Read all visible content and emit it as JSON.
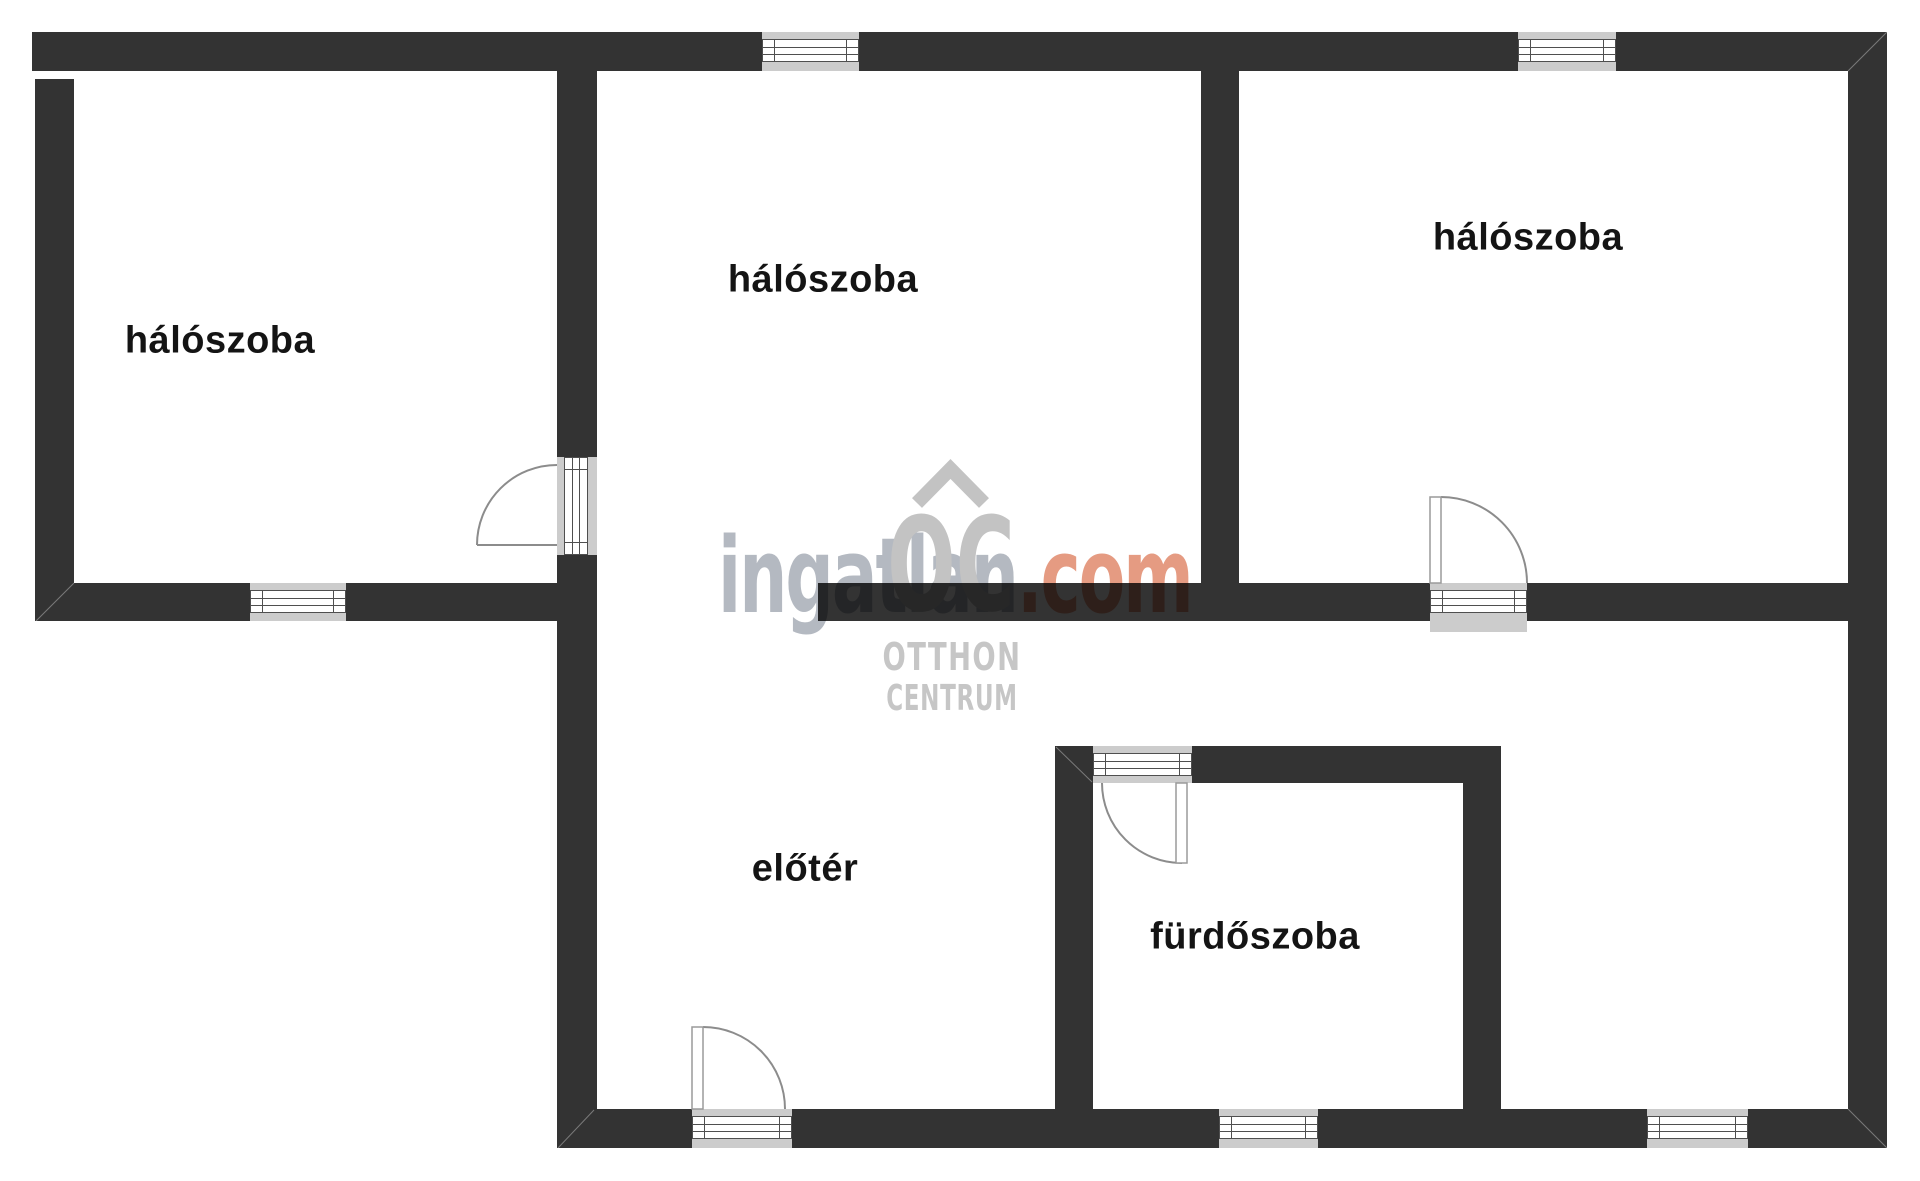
{
  "page": {
    "width": 1920,
    "height": 1181,
    "background": "#ffffff"
  },
  "colors": {
    "wall": "#333333",
    "opening_fill": "#cccccc",
    "pane_stroke": "#4f4f4f",
    "arc_stroke": "#8c8c8c",
    "leaf_stroke": "#9a9a9a",
    "seam": "rgba(255,255,255,0.35)",
    "label": "#141414",
    "watermark_gray": "#b4b9c1",
    "watermark_accent": "#e59b82",
    "logo_gray": "#c3c3c3",
    "logo_text_gray": "#c6c6c6"
  },
  "rooms": [
    {
      "id": "bedroom-left",
      "label": "hálószoba",
      "cx": 220,
      "cy": 341
    },
    {
      "id": "bedroom-middle",
      "label": "hálószoba",
      "cx": 823,
      "cy": 280
    },
    {
      "id": "bedroom-right",
      "label": "hálószoba",
      "cx": 1528,
      "cy": 238
    },
    {
      "id": "hallway",
      "label": "előtér",
      "cx": 805,
      "cy": 869
    },
    {
      "id": "bathroom",
      "label": "fürdőszoba",
      "cx": 1255,
      "cy": 937
    }
  ],
  "watermark": {
    "brand_main": "ingatlan",
    "brand_tld": ".com",
    "logo_initials": "OC",
    "logo_line1": "OTTHON",
    "logo_line2": "CENTRUM",
    "chevron_path": "M 917 503 L 950.5 469 L 984 503"
  },
  "floorplan": {
    "walls": [
      [
        32,
        32,
        730,
        39
      ],
      [
        859,
        32,
        659,
        39
      ],
      [
        1616,
        32,
        271,
        39
      ],
      [
        35,
        79,
        39,
        542
      ],
      [
        35,
        583,
        215,
        38
      ],
      [
        346,
        583,
        211,
        38
      ],
      [
        557,
        71,
        40,
        386
      ],
      [
        557,
        555,
        40,
        593
      ],
      [
        818,
        583,
        612,
        38
      ],
      [
        1527,
        583,
        360,
        38
      ],
      [
        1201,
        71,
        38,
        512
      ],
      [
        1848,
        32,
        39,
        1116
      ],
      [
        557,
        1109,
        135,
        39
      ],
      [
        792,
        1109,
        427,
        39
      ],
      [
        1318,
        1109,
        329,
        39
      ],
      [
        1748,
        1109,
        139,
        39
      ],
      [
        1192,
        746,
        309,
        37
      ],
      [
        1055,
        746,
        38,
        363
      ],
      [
        1463,
        783,
        38,
        326
      ]
    ],
    "windows": [
      {
        "x": 762,
        "y": 32,
        "w": 97,
        "h": 39,
        "o": "h"
      },
      {
        "x": 1518,
        "y": 32,
        "w": 98,
        "h": 39,
        "o": "h"
      },
      {
        "x": 250,
        "y": 583,
        "w": 96,
        "h": 38,
        "o": "h"
      },
      {
        "x": 1219,
        "y": 1109,
        "w": 99,
        "h": 39,
        "o": "h"
      },
      {
        "x": 1647,
        "y": 1109,
        "w": 101,
        "h": 39,
        "o": "h"
      }
    ],
    "thresholds": [
      {
        "x": 557,
        "y": 457,
        "w": 40,
        "h": 98,
        "o": "v"
      },
      {
        "x": 1430,
        "y": 583,
        "w": 97,
        "h": 49,
        "o": "h"
      },
      {
        "x": 692,
        "y": 1109,
        "w": 100,
        "h": 39,
        "o": "h"
      },
      {
        "x": 1093,
        "y": 746,
        "w": 99,
        "h": 37,
        "o": "h"
      }
    ],
    "doors": [
      {
        "arc": "M 477 545 A 80 80 0 0 1 557 465",
        "leaf": {
          "type": "line",
          "x1": 477,
          "y1": 545,
          "x2": 557,
          "y2": 545
        }
      },
      {
        "arc": "M 1441 497 A 86 86 0 0 1 1527 583",
        "leaf": {
          "type": "rect",
          "x": 1430,
          "y": 497,
          "w": 11,
          "h": 86
        }
      },
      {
        "arc": "M 703 1027 A 82 82 0 0 1 785 1109",
        "leaf": {
          "type": "rect",
          "x": 692,
          "y": 1027,
          "w": 11,
          "h": 82
        }
      },
      {
        "arc": "M 1182 863 A 80 80 0 0 1 1102 783",
        "leaf": {
          "type": "rect",
          "x": 1176,
          "y": 783,
          "w": 11,
          "h": 80
        }
      }
    ],
    "seams": [
      [
        1848,
        71,
        1887,
        32
      ],
      [
        1848,
        1109,
        1887,
        1148
      ],
      [
        74,
        583,
        36,
        621
      ],
      [
        594,
        1110,
        558,
        1148
      ],
      [
        1056,
        747,
        1092,
        782
      ]
    ]
  }
}
